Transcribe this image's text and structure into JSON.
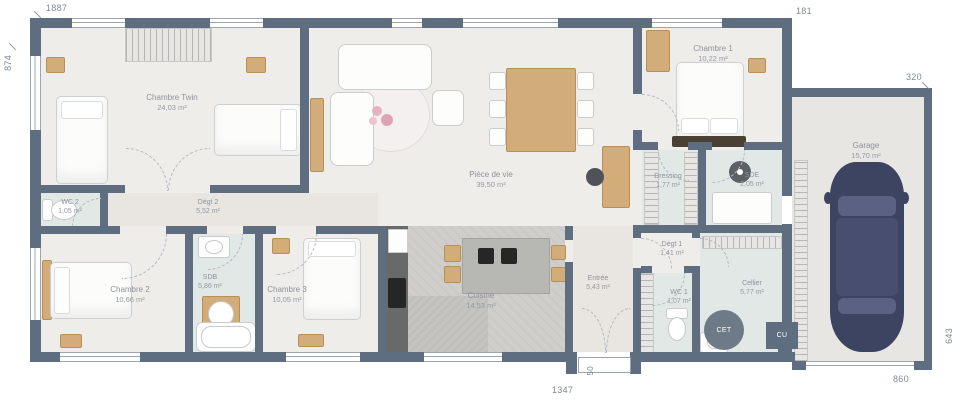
{
  "plan": {
    "rooms": {
      "chambre_twin": {
        "name": "Chambre Twin",
        "area": "24,03 m²"
      },
      "degt2": {
        "name": "Dégt 2",
        "area": "5,52 m²"
      },
      "wc2": {
        "name": "WC 2",
        "area": "1,05 m²"
      },
      "chambre2": {
        "name": "Chambre 2",
        "area": "10,66 m²"
      },
      "sdb": {
        "name": "SDB",
        "area": "5,86 m²"
      },
      "chambre3": {
        "name": "Chambre 3",
        "area": "10,05 m²"
      },
      "piece_de_vie": {
        "name": "Pièce de vie",
        "area": "39,50 m²"
      },
      "cuisine": {
        "name": "Cuisine",
        "area": "14,53 m²"
      },
      "chambre1": {
        "name": "Chambre 1",
        "area": "10,22 m²"
      },
      "dressing": {
        "name": "Dressing",
        "area": "1,77 m²"
      },
      "sde": {
        "name": "SDE",
        "area": "2,05 m²"
      },
      "degt1": {
        "name": "Dégt 1",
        "area": "1,41 m²"
      },
      "entree": {
        "name": "Entrée",
        "area": "5,43 m²"
      },
      "wc1": {
        "name": "WC 1",
        "area": "1,07 m²"
      },
      "cellier": {
        "name": "Cellier",
        "area": "5,77 m²"
      },
      "garage": {
        "name": "Garage",
        "area": "15,70 m²"
      }
    },
    "equipment": {
      "cet": "CET",
      "cu": "CU"
    },
    "dimensions": {
      "top": "1887",
      "left": "874",
      "top_right": "181",
      "garage_top": "320",
      "right": "643",
      "bottom_right": "860",
      "bottom": "1347",
      "entry_step": "50"
    },
    "colors": {
      "wall": "#5e6d80",
      "floor": "#efedea",
      "wet_room": "#e2e8e5",
      "hall": "#e9e6e1",
      "kitchen_concrete": "#cfcecb",
      "wood": "#d3ad79",
      "car": "#3d4462"
    }
  }
}
